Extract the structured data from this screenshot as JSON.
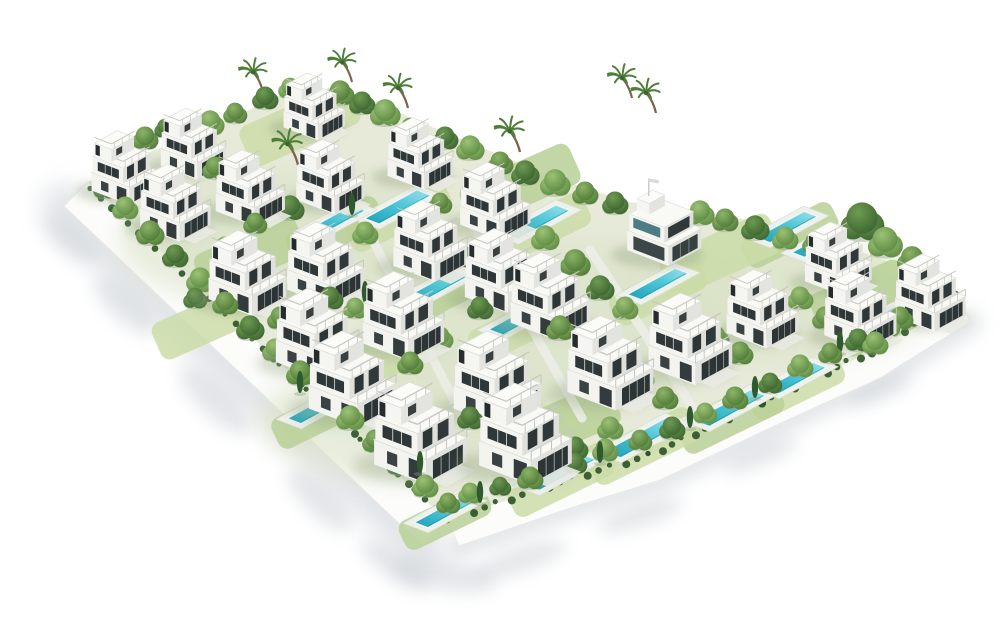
{
  "scene": {
    "background": "#ffffff",
    "palette": {
      "villaLeftFace": "#f3f3f0",
      "villaRightFace": "#e1e2dd",
      "villaRoof": "#f9f9f6",
      "villaEdge": "#dddfd8",
      "windowDark": "#2d3435",
      "windowGlass": "#39424 3",
      "railing": "#c6c7c2",
      "wall": "#fcfcfb",
      "wallEdge": "#e9ebea",
      "shadow": "#c9cfd3",
      "groundBase": "#e7ead9",
      "groundTint": "#d9e2c6",
      "lawnA": "#cbdca8",
      "lawnB": "#b9d096",
      "path": "#ecede8",
      "hedge": "#2e5529",
      "poolDeep": "#1d9fb6",
      "poolMain": "#4ec6d8",
      "poolLight": "#9fe4ee",
      "poolDeck": "#eef0ea",
      "trunk": "#7a654c",
      "palmFrond": "#4e7f3a",
      "cypress": "#2e5a2e",
      "treeShadow": "#8fa07b",
      "greens": [
        [
          "#8cb468",
          "#4f7a37"
        ],
        [
          "#9cc276",
          "#5d8a42"
        ],
        [
          "#6f9a52",
          "#3b6530"
        ],
        [
          "#aac983",
          "#6f9a50"
        ]
      ]
    },
    "boundary": {
      "top": [
        [
          88,
          182
        ],
        [
          150,
          152
        ],
        [
          210,
          127
        ],
        [
          255,
          107
        ],
        [
          300,
          85
        ],
        [
          360,
          95
        ],
        [
          420,
          122
        ],
        [
          470,
          143
        ],
        [
          520,
          163
        ],
        [
          575,
          185
        ],
        [
          630,
          202
        ],
        [
          690,
          210
        ],
        [
          750,
          220
        ],
        [
          810,
          235
        ],
        [
          870,
          255
        ],
        [
          915,
          272
        ],
        [
          958,
          295
        ]
      ],
      "innerRight": [
        [
          958,
          295
        ],
        [
          870,
          352
        ],
        [
          760,
          402
        ],
        [
          650,
          455
        ],
        [
          560,
          482
        ],
        [
          447,
          520
        ]
      ],
      "leftWall": [
        [
          88,
          182
        ],
        [
          447,
          520
        ],
        [
          423,
          546
        ],
        [
          64,
          206
        ]
      ],
      "rightWall": [
        [
          447,
          520
        ],
        [
          560,
          482
        ],
        [
          650,
          455
        ],
        [
          760,
          402
        ],
        [
          870,
          352
        ],
        [
          958,
          295
        ],
        [
          970,
          322
        ],
        [
          880,
          378
        ],
        [
          770,
          428
        ],
        [
          660,
          480
        ],
        [
          570,
          508
        ],
        [
          459,
          546
        ]
      ],
      "outerLeft": [
        [
          64,
          206
        ],
        [
          423,
          546
        ]
      ],
      "outerRight": [
        [
          459,
          546
        ],
        [
          570,
          508
        ],
        [
          660,
          480
        ],
        [
          770,
          428
        ],
        [
          880,
          378
        ],
        [
          970,
          322
        ]
      ]
    },
    "shadowBlobs": [
      [
        70,
        240,
        34,
        13,
        40
      ],
      [
        125,
        305,
        40,
        16,
        43
      ],
      [
        215,
        400,
        46,
        17,
        44
      ],
      [
        320,
        500,
        42,
        16,
        44
      ],
      [
        395,
        565,
        40,
        14,
        35
      ],
      [
        445,
        575,
        52,
        16,
        10
      ],
      [
        520,
        560,
        48,
        13,
        -18
      ],
      [
        640,
        515,
        44,
        12,
        -18
      ],
      [
        760,
        455,
        40,
        11,
        -22
      ],
      [
        880,
        390,
        36,
        10,
        -24
      ]
    ],
    "groundTintBlobs": [
      [
        300,
        240,
        180,
        70
      ],
      [
        560,
        320,
        200,
        80
      ],
      [
        780,
        300,
        150,
        60
      ],
      [
        420,
        420,
        160,
        60
      ]
    ],
    "lawns": [
      [
        398,
        215,
        110,
        36,
        -26
      ],
      [
        335,
        230,
        100,
        34,
        -26
      ],
      [
        537,
        230,
        110,
        36,
        -26
      ],
      [
        790,
        235,
        100,
        32,
        -26
      ],
      [
        658,
        292,
        100,
        34,
        -26
      ],
      [
        435,
        296,
        110,
        36,
        -26
      ],
      [
        522,
        326,
        110,
        36,
        -26
      ],
      [
        880,
        328,
        85,
        30,
        -26
      ],
      [
        796,
        386,
        100,
        34,
        -26
      ],
      [
        730,
        416,
        110,
        38,
        -26
      ],
      [
        643,
        446,
        115,
        38,
        -26
      ],
      [
        318,
        416,
        95,
        34,
        -26
      ],
      [
        560,
        480,
        110,
        36,
        -26
      ],
      [
        445,
        518,
        95,
        32,
        -26
      ],
      [
        300,
        125,
        120,
        44,
        -24
      ],
      [
        520,
        185,
        120,
        44,
        -24
      ],
      [
        720,
        255,
        120,
        44,
        -24
      ],
      [
        860,
        295,
        100,
        40,
        -24
      ],
      [
        380,
        355,
        130,
        48,
        -24
      ],
      [
        250,
        255,
        110,
        44,
        -24
      ],
      [
        200,
        325,
        95,
        40,
        -24
      ],
      [
        560,
        425,
        120,
        46,
        -24
      ]
    ],
    "road": [
      [
        452,
        500
      ],
      [
        560,
        468
      ],
      [
        650,
        440
      ],
      [
        758,
        390
      ],
      [
        866,
        342
      ],
      [
        930,
        308
      ]
    ],
    "spinePaths": [
      [
        [
          355,
          205
        ],
        [
          468,
          428
        ]
      ],
      [
        [
          468,
          215
        ],
        [
          582,
          418
        ]
      ],
      [
        [
          590,
          250
        ],
        [
          700,
          418
        ]
      ]
    ],
    "pools": [
      [
        398,
        207,
        60,
        16
      ],
      [
        335,
        221,
        55,
        15
      ],
      [
        537,
        222,
        60,
        16
      ],
      [
        787,
        227,
        55,
        15
      ],
      [
        820,
        243,
        50,
        14
      ],
      [
        658,
        284,
        55,
        15
      ],
      [
        435,
        288,
        60,
        16
      ],
      [
        522,
        318,
        60,
        16
      ],
      [
        880,
        320,
        45,
        13
      ],
      [
        796,
        378,
        55,
        15
      ],
      [
        730,
        408,
        65,
        17
      ],
      [
        643,
        438,
        70,
        18
      ],
      [
        318,
        408,
        55,
        15
      ],
      [
        560,
        472,
        65,
        17
      ],
      [
        445,
        512,
        55,
        15
      ]
    ],
    "villas": [
      [
        314,
        106,
        1.02
      ],
      [
        193,
        143,
        1.08
      ],
      [
        420,
        153,
        1.09
      ],
      [
        125,
        167,
        1.12
      ],
      [
        330,
        176,
        1.13
      ],
      [
        250,
        187,
        1.15
      ],
      [
        495,
        200,
        1.17
      ],
      [
        175,
        202,
        1.17
      ],
      [
        247,
        272,
        1.29
      ],
      [
        325,
        263,
        1.27
      ],
      [
        430,
        240,
        1.23
      ],
      [
        503,
        270,
        1.28
      ],
      [
        550,
        295,
        1.32
      ],
      [
        317,
        333,
        1.38
      ],
      [
        403,
        315,
        1.35
      ],
      [
        610,
        362,
        1.43
      ],
      [
        690,
        338,
        1.39
      ],
      [
        762,
        308,
        1.19
      ],
      [
        838,
        258,
        1.11
      ],
      [
        860,
        310,
        1.2
      ],
      [
        930,
        292,
        1.17
      ],
      [
        497,
        378,
        1.45
      ],
      [
        525,
        433,
        1.54
      ],
      [
        420,
        432,
        1.54
      ],
      [
        352,
        378,
        1.45
      ]
    ],
    "clubhouse": [
      662,
      233,
      1.1
    ],
    "trees": [
      [
        120,
        150,
        13,
        1
      ],
      [
        145,
        140,
        12,
        0
      ],
      [
        165,
        130,
        10,
        2
      ],
      [
        210,
        125,
        13,
        1
      ],
      [
        235,
        115,
        11,
        0
      ],
      [
        265,
        100,
        12,
        2
      ],
      [
        290,
        90,
        11,
        1
      ],
      [
        340,
        95,
        13,
        0
      ],
      [
        362,
        105,
        12,
        2
      ],
      [
        385,
        115,
        14,
        1
      ],
      [
        410,
        130,
        11,
        0
      ],
      [
        445,
        140,
        12,
        2
      ],
      [
        470,
        150,
        13,
        1
      ],
      [
        500,
        165,
        12,
        0
      ],
      [
        525,
        175,
        13,
        2
      ],
      [
        555,
        185,
        14,
        1
      ],
      [
        585,
        195,
        12,
        0
      ],
      [
        615,
        205,
        12,
        2
      ],
      [
        700,
        215,
        13,
        1
      ],
      [
        725,
        222,
        12,
        0
      ],
      [
        755,
        230,
        13,
        2
      ],
      [
        785,
        240,
        12,
        1
      ],
      [
        815,
        245,
        12,
        0
      ],
      [
        862,
        225,
        20,
        2
      ],
      [
        885,
        245,
        16,
        1
      ],
      [
        912,
        262,
        14,
        0
      ],
      [
        935,
        288,
        12,
        2
      ],
      [
        105,
        190,
        11,
        2
      ],
      [
        125,
        210,
        12,
        1
      ],
      [
        150,
        235,
        13,
        0
      ],
      [
        175,
        258,
        12,
        2
      ],
      [
        200,
        282,
        13,
        1
      ],
      [
        225,
        305,
        12,
        0
      ],
      [
        250,
        330,
        13,
        2
      ],
      [
        275,
        352,
        12,
        1
      ],
      [
        300,
        375,
        13,
        0
      ],
      [
        325,
        398,
        12,
        2
      ],
      [
        350,
        420,
        13,
        1
      ],
      [
        375,
        443,
        12,
        0
      ],
      [
        400,
        465,
        13,
        2
      ],
      [
        425,
        488,
        12,
        1
      ],
      [
        448,
        505,
        11,
        0
      ],
      [
        470,
        495,
        11,
        1
      ],
      [
        500,
        488,
        10,
        2
      ],
      [
        530,
        480,
        12,
        0
      ],
      [
        575,
        465,
        11,
        2
      ],
      [
        605,
        452,
        12,
        1
      ],
      [
        640,
        442,
        11,
        0
      ],
      [
        672,
        430,
        12,
        2
      ],
      [
        705,
        415,
        11,
        1
      ],
      [
        735,
        400,
        12,
        0
      ],
      [
        770,
        385,
        11,
        2
      ],
      [
        800,
        368,
        12,
        1
      ],
      [
        830,
        355,
        11,
        0
      ],
      [
        858,
        342,
        12,
        2
      ],
      [
        888,
        328,
        11,
        1
      ],
      [
        915,
        315,
        10,
        0
      ],
      [
        938,
        300,
        9,
        2
      ],
      [
        215,
        170,
        12,
        0
      ],
      [
        290,
        210,
        13,
        2
      ],
      [
        365,
        235,
        12,
        1
      ],
      [
        440,
        205,
        11,
        0
      ],
      [
        465,
        260,
        12,
        2
      ],
      [
        545,
        240,
        13,
        1
      ],
      [
        575,
        265,
        14,
        0
      ],
      [
        600,
        290,
        13,
        2
      ],
      [
        625,
        310,
        12,
        1
      ],
      [
        560,
        330,
        13,
        0
      ],
      [
        585,
        355,
        12,
        2
      ],
      [
        640,
        380,
        13,
        1
      ],
      [
        665,
        400,
        12,
        0
      ],
      [
        690,
        370,
        12,
        2
      ],
      [
        715,
        340,
        13,
        1
      ],
      [
        740,
        355,
        12,
        0
      ],
      [
        770,
        330,
        13,
        2
      ],
      [
        800,
        300,
        12,
        1
      ],
      [
        825,
        320,
        12,
        0
      ],
      [
        850,
        335,
        13,
        2
      ],
      [
        875,
        345,
        12,
        1
      ],
      [
        900,
        320,
        12,
        0
      ],
      [
        480,
        310,
        12,
        2
      ],
      [
        440,
        340,
        12,
        1
      ],
      [
        410,
        365,
        12,
        0
      ],
      [
        470,
        420,
        12,
        2
      ],
      [
        500,
        450,
        12,
        1
      ],
      [
        540,
        465,
        11,
        0
      ],
      [
        575,
        450,
        12,
        2
      ],
      [
        610,
        430,
        12,
        1
      ],
      [
        255,
        225,
        11,
        0
      ],
      [
        330,
        300,
        12,
        2
      ],
      [
        225,
        250,
        12,
        1
      ],
      [
        195,
        300,
        11,
        2
      ],
      [
        280,
        320,
        12,
        0
      ],
      [
        355,
        310,
        11,
        1
      ]
    ],
    "palms": [
      [
        263,
        92
      ],
      [
        352,
        82
      ],
      [
        632,
        98
      ],
      [
        656,
        113
      ],
      [
        408,
        108
      ],
      [
        520,
        152
      ],
      [
        298,
        165
      ]
    ],
    "cypresses": [
      [
        352,
        212
      ],
      [
        480,
        295
      ],
      [
        565,
        315
      ],
      [
        690,
        425
      ],
      [
        755,
        395
      ],
      [
        600,
        460
      ],
      [
        480,
        500
      ],
      [
        840,
        350
      ],
      [
        300,
        390
      ],
      [
        420,
        470
      ],
      [
        545,
        300
      ],
      [
        365,
        300
      ]
    ]
  }
}
